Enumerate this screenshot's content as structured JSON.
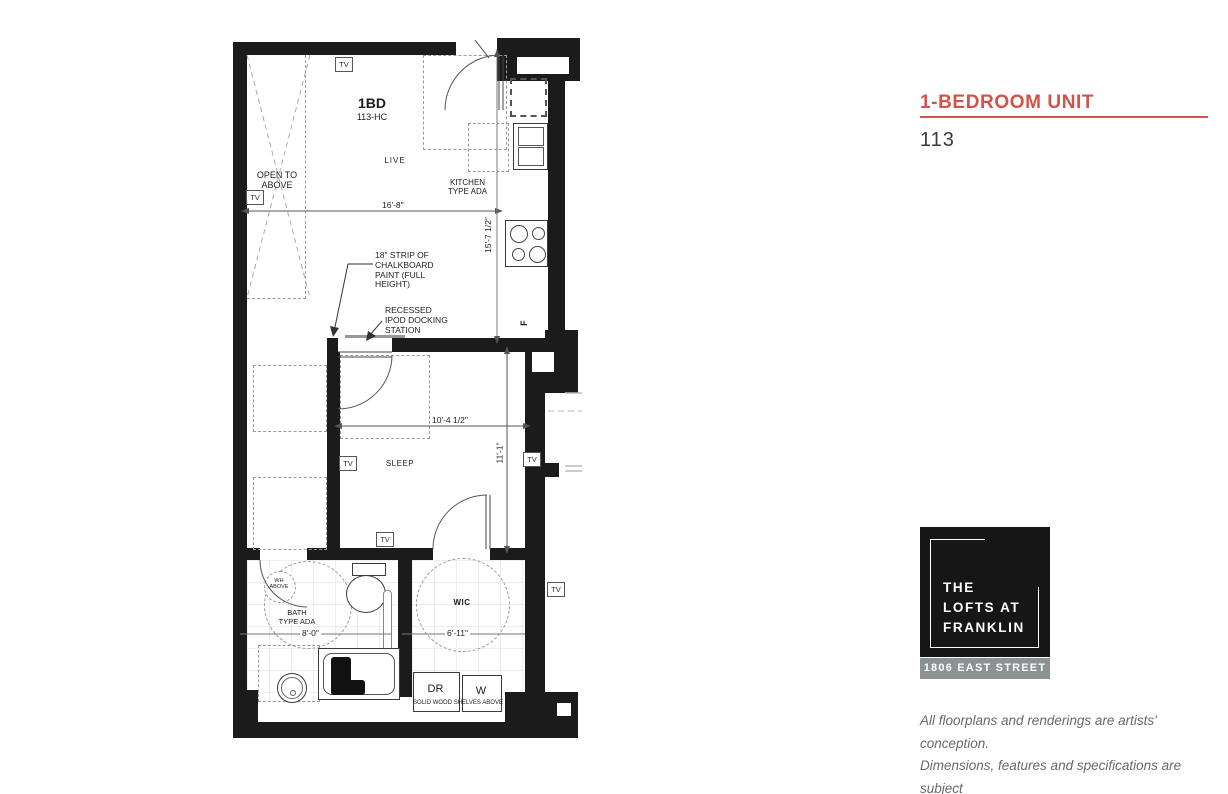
{
  "plan": {
    "unit_label": "1BD",
    "unit_code": "113-HC",
    "labels": {
      "live": "LIVE",
      "sleep": "SLEEP",
      "kitchen": "KITCHEN\nTYPE ADA",
      "bath": "BATH\nTYPE ADA",
      "wic": "WIC",
      "open_above": "OPEN TO\nABOVE",
      "wh_above": "WH\nABOVE",
      "fridge": "F",
      "dryer": "DR",
      "washer": "W",
      "shelves": "SOLID WOOD SHELVES ABOVE",
      "tv": "TV"
    },
    "dimensions": {
      "live_width": "16'-8\"",
      "kitchen_depth": "15'-7 1/2\"",
      "sleep_width": "10'-4 1/2\"",
      "sleep_depth": "11'-1\"",
      "bath_width": "8'-0\"",
      "wic_width": "6'-11\""
    },
    "annotations": {
      "chalkboard": "18\" STRIP OF\nCHALKBOARD\nPAINT (FULL\nHEIGHT)",
      "ipod_dock": "RECESSED\nIPOD DOCKING\nSTATION"
    }
  },
  "panel": {
    "title": "1-BEDROOM UNIT",
    "unit_number": "113",
    "logo": {
      "name": "THE\nLOFTS AT\nFRANKLIN",
      "address": "1806 EAST STREET"
    },
    "disclaimer": "All floorplans and renderings are artists' conception.\nDimensions, features and specifications are subject\nto change at the discretion of the builder."
  },
  "colors": {
    "accent": "#d0544a",
    "address_bar": "#8b9293"
  }
}
